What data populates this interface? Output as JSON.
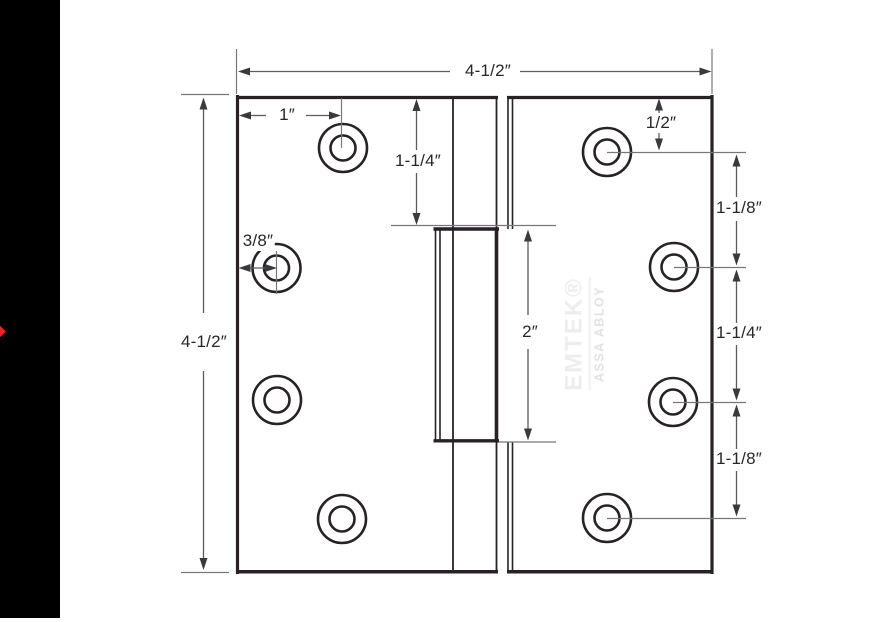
{
  "drawing": {
    "type": "hinge-dimension-diagram",
    "subject": "4-1/2 inch square door hinge, side view with screw holes and barrel",
    "labels": {
      "overall_width": "4-1/2″",
      "overall_height": "4-1/2″",
      "hole_offset_top": "1″",
      "plate_top_to_barrel": "1-1/4″",
      "edge_to_hole": "3/8″",
      "barrel_length": "2″",
      "right_top_to_hole": "1/2″",
      "right_gap_1": "1-1/8″",
      "right_gap_2": "1-1/4″",
      "right_gap_3": "1-1/8″"
    },
    "watermark": {
      "brand": "EMTEK®",
      "group": "ASSA ABLOY"
    },
    "colors": {
      "plate_line": "#262226",
      "dimension_line": "#5c5c60",
      "extension_line": "#77777a",
      "arrow": "#3a393c",
      "text": "#29262a",
      "watermark": "#ededed",
      "marker": "#e8252a",
      "side_band": "#000000"
    }
  }
}
